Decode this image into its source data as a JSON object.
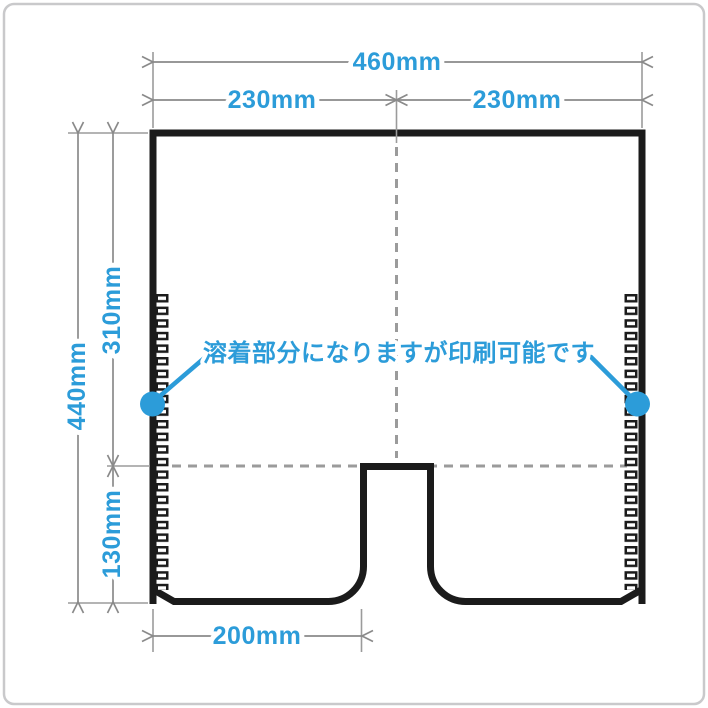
{
  "diagram": {
    "annotation": "溶着部分になりますが印刷可能です",
    "dims": {
      "total_width": "460mm",
      "half_left": "230mm",
      "half_right": "230mm",
      "total_height": "440mm",
      "upper_height": "310mm",
      "lower_height": "130mm",
      "bottom_width": "200mm"
    },
    "colors": {
      "accent_blue": "#2c9cd9",
      "outline_black": "#1b1b1b",
      "dimension_gray": "#8a8a8a",
      "frame_gray": "#c9c9cb"
    }
  }
}
